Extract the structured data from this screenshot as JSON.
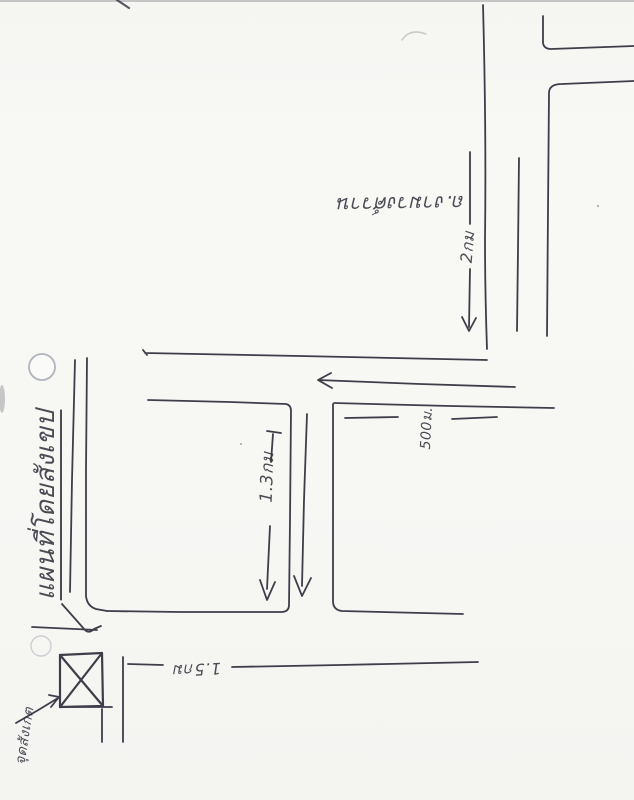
{
  "paper": {
    "background": "#f7f7f4",
    "ink": "#3e3e4a"
  },
  "labels": {
    "map_title": "แผนที่โดยสังเขป",
    "road_name_top": "ถ.งามวงศ์วาน",
    "distance_top_road": "2กม",
    "distance_middle_road": "500ม.",
    "distance_lower_road": "1.3กม",
    "distance_bottom_road": "1.5กม",
    "destination_note": "จุดสังเกต"
  }
}
